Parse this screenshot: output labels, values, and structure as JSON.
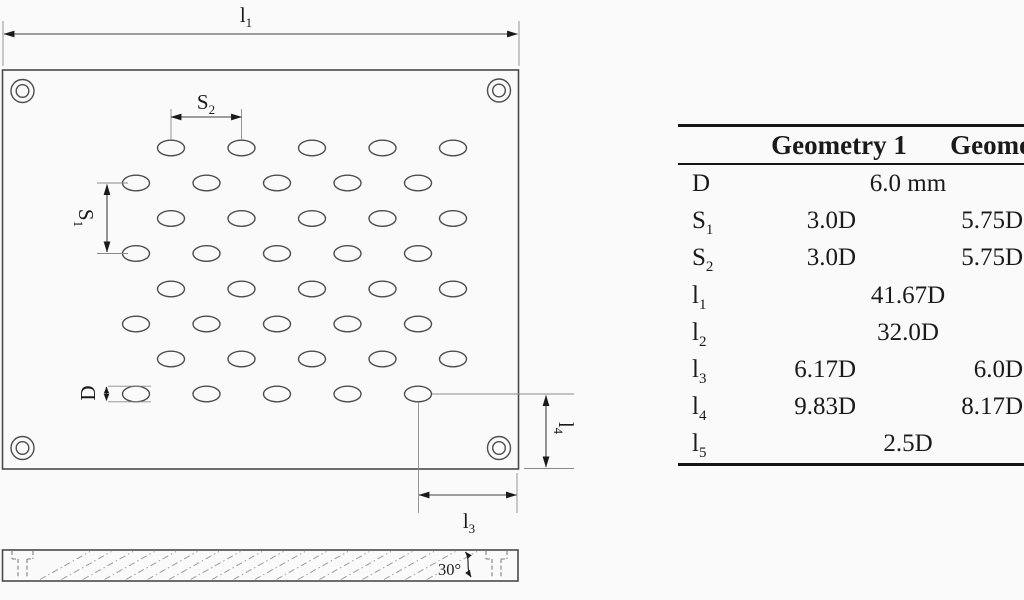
{
  "figure": {
    "type": "perforated-plate-geometry-figure",
    "dim_labels": {
      "l1": {
        "base": "l",
        "sub": "1"
      },
      "s2": {
        "base": "S",
        "sub": "2"
      },
      "s1": {
        "base": "S",
        "sub": "1"
      },
      "d": {
        "base": "D",
        "sub": ""
      },
      "l4": {
        "base": "l",
        "sub": "4"
      },
      "l3": {
        "base": "l",
        "sub": "3"
      },
      "angle": "30°"
    }
  },
  "table": {
    "header": {
      "param": "",
      "g1": "Geometry 1",
      "g2": "Geometry 2"
    },
    "rows": [
      {
        "param": "D",
        "sub": "",
        "span": "6.0 mm"
      },
      {
        "param": "S",
        "sub": "1",
        "g1": "3.0D",
        "g2": "5.75D"
      },
      {
        "param": "S",
        "sub": "2",
        "g1": "3.0D",
        "g2": "5.75D"
      },
      {
        "param": "l",
        "sub": "1",
        "span": "41.67D"
      },
      {
        "param": "l",
        "sub": "2",
        "span": "32.0D"
      },
      {
        "param": "l",
        "sub": "3",
        "g1": "6.17D",
        "g2": "6.0D"
      },
      {
        "param": "l",
        "sub": "4",
        "g1": "9.83D",
        "g2": "8.17D"
      },
      {
        "param": "l",
        "sub": "5",
        "span": "2.5D"
      }
    ]
  },
  "colors": {
    "background": "#fafafa",
    "drawing_line": "#4d4d4d",
    "dimension_line": "#3f3f3f",
    "extension_line": "#8a8a8a",
    "text": "#1a1a1a",
    "table_rule": "#151515"
  }
}
